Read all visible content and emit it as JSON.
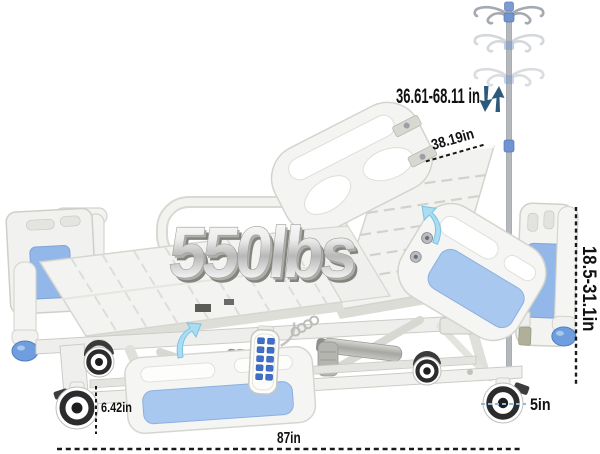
{
  "image": {
    "type": "hospital-bed-dimension-diagram",
    "background": "#ffffff"
  },
  "labels": {
    "capacity": "550lbs",
    "pole_height": "36.61-68.11 in",
    "backrest_width": "38.19in",
    "height_range": "18.5-31.1in",
    "clearance": "6.42in",
    "caster": "5in",
    "length": "87in"
  },
  "colors": {
    "panel_blue": "#a9c8f0",
    "headboard_blue": "#93b7e8",
    "knob_blue": "#6f9ede",
    "grip_blue": "#4a7ac6",
    "button_blue": "#3f6fc8",
    "dim_text": "#111111",
    "dim_arrow_blue": "#2d5a7a",
    "hint_arrow_blue": "#aadcf2",
    "bed_body": "#f3f3f1",
    "bed_edge": "#d4d4ce",
    "caster_dark": "#2c2c2c"
  },
  "icons": {
    "pole_down": "down-arrow-icon",
    "pole_up": "up-arrow-icon",
    "adjust_hint": "curved-up-arrow-icon"
  }
}
